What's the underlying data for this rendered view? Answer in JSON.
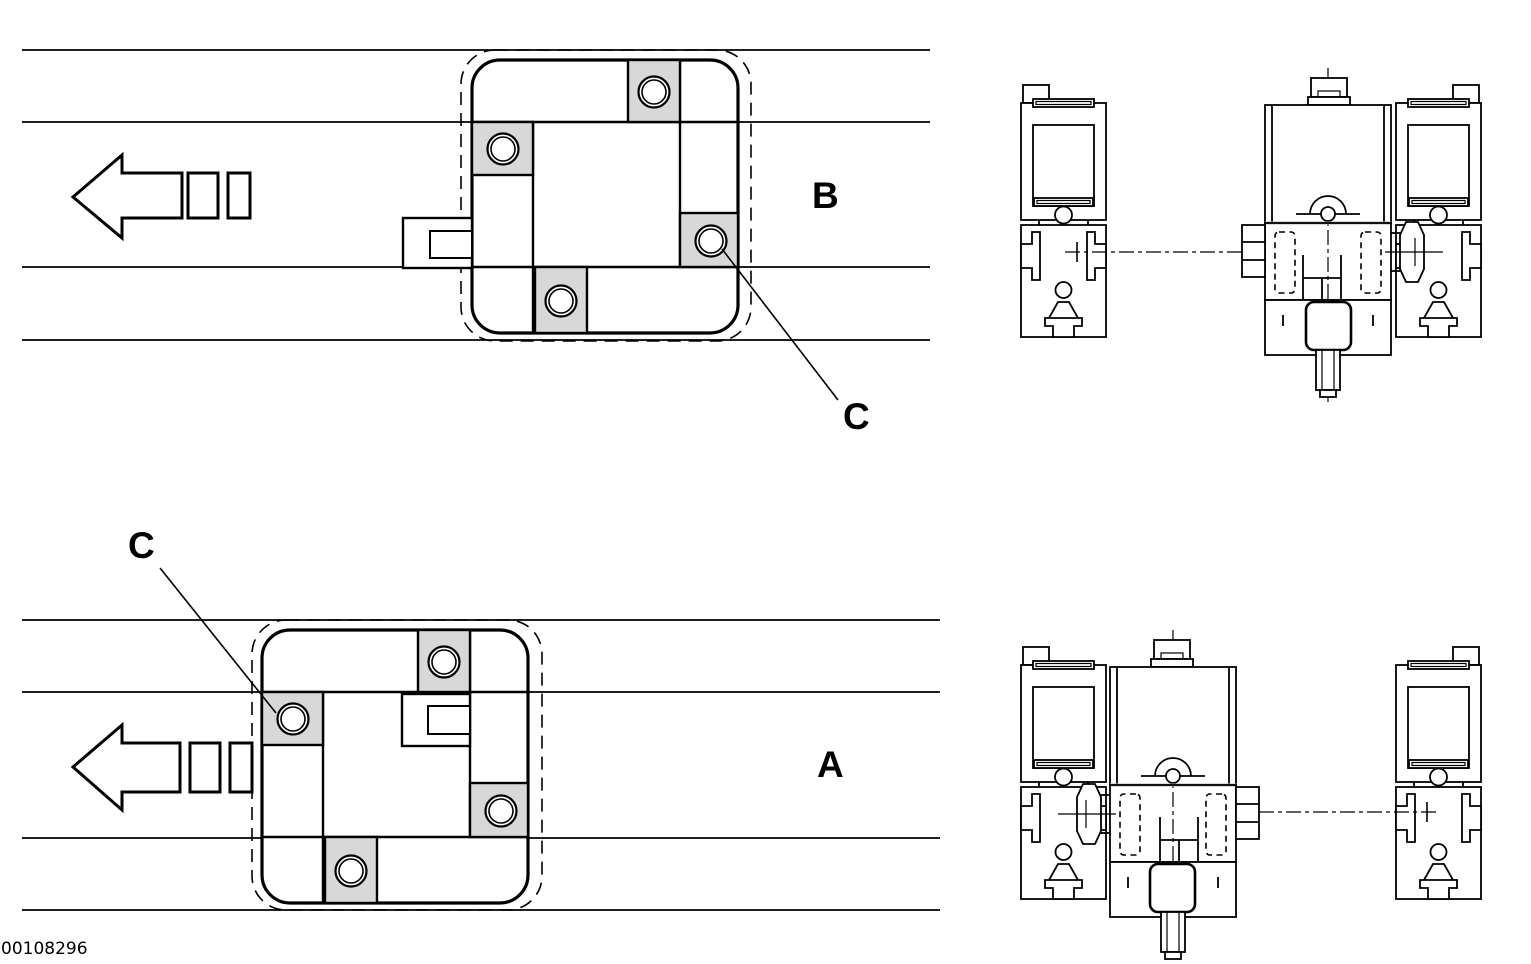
{
  "image_id": "00108296",
  "background": "#ffffff",
  "colors": {
    "line": "#000000",
    "roller_fill": "#d8d8d8",
    "belt_band": "#b4b4b4"
  },
  "views": {
    "top": {
      "label": "B",
      "detail_label": "C",
      "description": "Plan view of workpiece pallet, orientation B, travel direction left, with section view of conveyor profiles and roller unit mounted at right profile"
    },
    "bottom": {
      "label": "A",
      "detail_label": "C",
      "description": "Plan view of workpiece pallet, orientation A, travel direction left, with section view of conveyor profiles and roller unit mounted at left profile"
    }
  }
}
